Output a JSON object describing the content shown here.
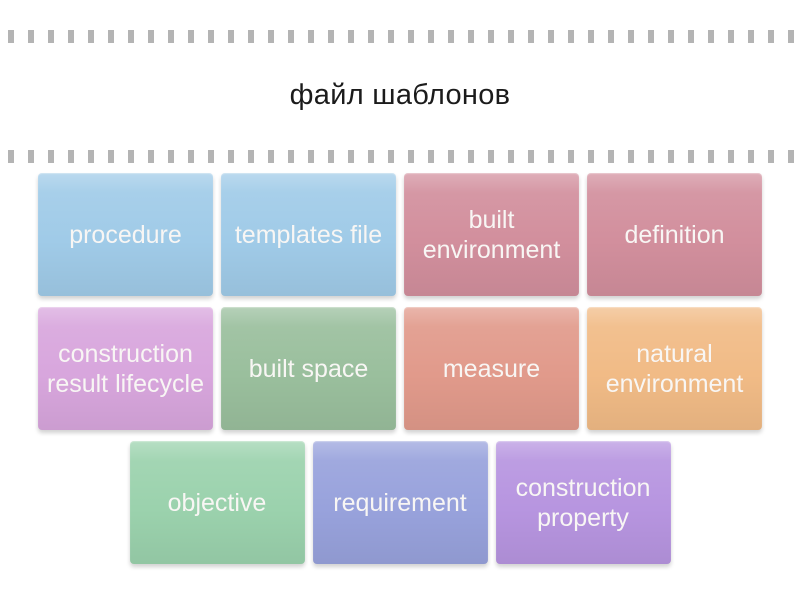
{
  "page": {
    "title": "файл шаблонов",
    "title_color": "#1b1b1b",
    "background_color": "#ffffff",
    "perforation_color": "#b4b4b4"
  },
  "tiles": {
    "text_color": "#f8f6f4",
    "rows": [
      [
        {
          "label": "procedure",
          "color": "#a0cbe8"
        },
        {
          "label": "templates file",
          "color": "#a0cbe8"
        },
        {
          "label": "built environment",
          "color": "#d28f9d"
        },
        {
          "label": "definition",
          "color": "#d28f9d"
        }
      ],
      [
        {
          "label": "construction result lifecycle",
          "color": "#d8a6dd"
        },
        {
          "label": "built space",
          "color": "#9abf9d"
        },
        {
          "label": "measure",
          "color": "#e19a8b"
        },
        {
          "label": "natural environment",
          "color": "#f1bb86"
        }
      ],
      [
        {
          "label": "objective",
          "color": "#9bd2ad"
        },
        {
          "label": "requirement",
          "color": "#98a2dc"
        },
        {
          "label": "construction property",
          "color": "#b795e0"
        }
      ]
    ]
  }
}
